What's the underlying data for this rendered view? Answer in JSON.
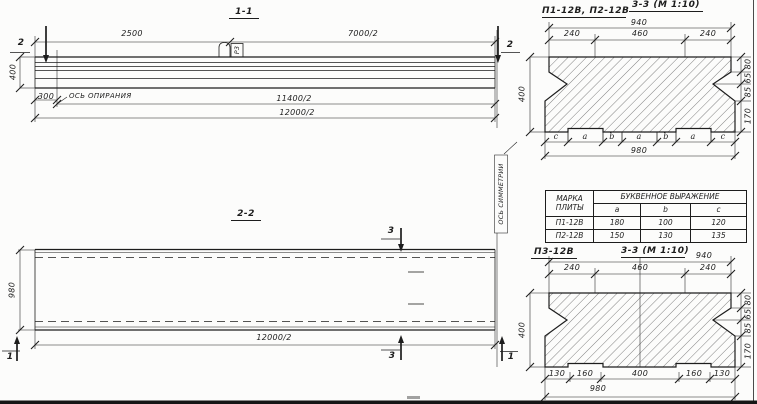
{
  "s11": {
    "title": "1-1",
    "dim_2500": "2500",
    "dim_7000": "7000/2",
    "dim_400": "400",
    "dim_300": "300",
    "support_axis": "ОСЬ ОПИРАНИЯ",
    "dim_11400": "11400/2",
    "dim_12000": "12000/2",
    "loop_mark": "Р3",
    "cut_left": "2",
    "cut_right": "2"
  },
  "s22": {
    "title": "2-2",
    "dim_980": "980",
    "dim_12000": "12000/2",
    "cut_top": "3",
    "cut_bottom": "3",
    "cut_left": "1",
    "cut_right": "1",
    "symmetry_axis": "ОСЬ СИММЕТРИИ"
  },
  "s33a": {
    "label": "П1-12В, П2-12В",
    "title": "3-3 (М 1:10)",
    "dim_940": "940",
    "dim_top": [
      "240",
      "460",
      "240"
    ],
    "dim_400": "400",
    "dim_right": [
      "80",
      "65",
      "85",
      "170"
    ],
    "letters": [
      "c",
      "a",
      "b",
      "a",
      "b",
      "a",
      "c"
    ],
    "dim_980": "980"
  },
  "plate_table": {
    "col_mark": "МАРКА ПЛИТЫ",
    "col_expr": "БУКВЕННОЕ ВЫРАЖЕНИЕ",
    "sub": [
      "a",
      "b",
      "c"
    ],
    "rows": [
      {
        "mark": "П1-12В",
        "a": "180",
        "b": "100",
        "c": "120"
      },
      {
        "mark": "П2-12В",
        "a": "150",
        "b": "130",
        "c": "135"
      }
    ]
  },
  "s33b": {
    "label": "П3-12В",
    "title": "3-3 (М 1:10)",
    "dim_940": "940",
    "dim_top": [
      "240",
      "460",
      "240"
    ],
    "dim_400": "400",
    "dim_right": [
      "80",
      "65",
      "85",
      "170"
    ],
    "dim_bottom": [
      "130",
      "160",
      "400",
      "160",
      "130"
    ],
    "dim_980": "980"
  }
}
